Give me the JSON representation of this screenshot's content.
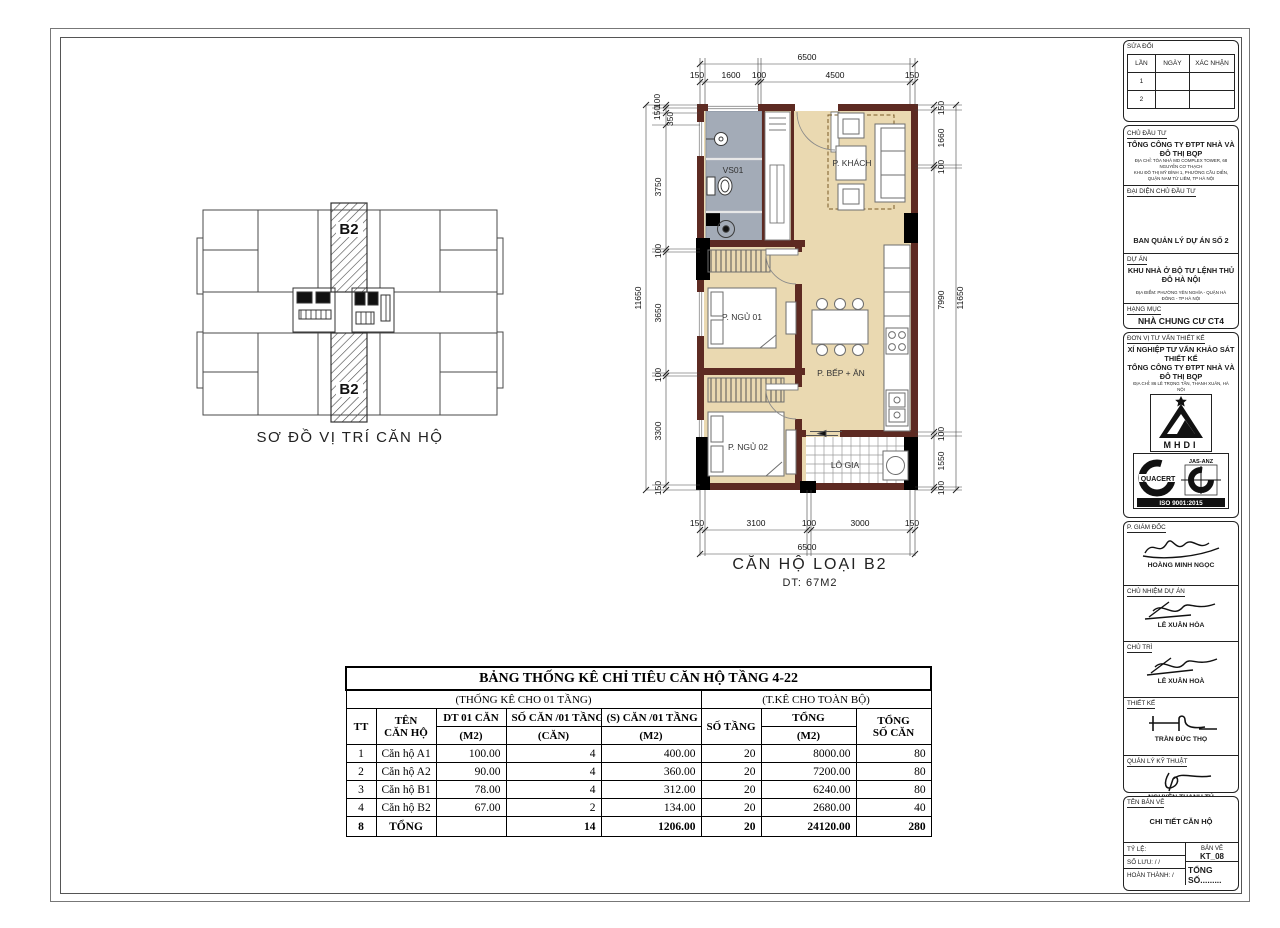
{
  "key_plan": {
    "caption": "SƠ ĐỒ VỊ TRÍ CĂN HỘ",
    "unit_top": "B2",
    "unit_bottom": "B2"
  },
  "floor_plan": {
    "caption_line1": "CĂN HỘ LOẠI B2",
    "caption_line2": "DT: 67M2",
    "rooms": {
      "bath": "VS01",
      "living": "P. KHÁCH",
      "bed1": "P. NGỦ 01",
      "kitchen": "P. BẾP + ĂN",
      "bed2": "P. NGỦ 02",
      "loggia": "LÔ GIA"
    },
    "dims": {
      "top_total": "6500",
      "top_segments": [
        "150",
        "1600",
        "100",
        "4500",
        "150"
      ],
      "bottom_segments": [
        "150",
        "3100",
        "100",
        "3000",
        "150"
      ],
      "bottom_total": "6500",
      "left_total": "11650",
      "left_segments": [
        "100",
        "150",
        "350",
        "3750",
        "100",
        "3650",
        "100",
        "3300",
        "150"
      ],
      "right_segments": [
        "150",
        "1660",
        "100",
        "7990",
        "100",
        "1550",
        "100"
      ],
      "right_total": "11650"
    },
    "colors": {
      "wall": "#5d2a22",
      "floor": "#ead9b1",
      "bath": "#a3abb7"
    }
  },
  "table": {
    "title": "BẢNG THỐNG KÊ CHỈ TIÊU CĂN HỘ TẦNG 4-22",
    "group_left": "(THỐNG KÊ CHO 01 TẦNG)",
    "group_right": "(T.KÊ CHO TOÀN BỘ)",
    "h1": [
      "TT",
      "TÊN",
      "DT 01 CĂN",
      "SỐ CĂN /01 TẦNG",
      "(S) CĂN /01 TẦNG",
      "SỐ TẦNG",
      "TỔNG",
      "TỔNG"
    ],
    "h2": [
      "",
      "CĂN HỘ",
      "(M2)",
      "(CĂN)",
      "(M2)",
      "",
      "(M2)",
      "SỐ CĂN"
    ],
    "rows": [
      [
        "1",
        "Căn hộ A1",
        "100.00",
        "4",
        "400.00",
        "20",
        "8000.00",
        "80"
      ],
      [
        "2",
        "Căn hộ A2",
        "90.00",
        "4",
        "360.00",
        "20",
        "7200.00",
        "80"
      ],
      [
        "3",
        "Căn hộ B1",
        "78.00",
        "4",
        "312.00",
        "20",
        "6240.00",
        "80"
      ],
      [
        "4",
        "Căn hộ B2",
        "67.00",
        "2",
        "134.00",
        "20",
        "2680.00",
        "40"
      ]
    ],
    "total": [
      "8",
      "TỔNG",
      "",
      "14",
      "1206.00",
      "20",
      "24120.00",
      "280"
    ]
  },
  "title_block": {
    "revision": {
      "title": "SỬA ĐỔI",
      "col1": "LẦN",
      "col2": "NGÀY",
      "col3": "XÁC NHẬN",
      "r1": "1",
      "r2": "2"
    },
    "investor": {
      "label": "CHỦ ĐẦU TƯ",
      "name": "TỔNG CÔNG TY ĐTPT NHÀ VÀ ĐÔ THỊ BQP",
      "address1": "ĐỊA CHỈ: TÒA NHÀ MD COMPLEX TOWER, 68 NGUYỄN CƠ THẠCH",
      "address2": "KHU ĐÔ THỊ MỸ ĐÌNH 1, PHƯỜNG CẦU DIỄN, QUẬN NAM TỪ LIÊM, TP HÀ NỘI",
      "rep_label": "ĐẠI DIỆN CHỦ ĐẦU TƯ",
      "rep_name": "BAN QUẢN LÝ DỰ ÁN SỐ 2"
    },
    "project": {
      "label": "DỰ ÁN",
      "name": "KHU NHÀ Ở BỘ TƯ LỆNH THỦ ĐÔ HÀ NỘI",
      "address": "ĐỊA ĐIỂM: PHƯỜNG YÊN NGHĨA - QUẬN HÀ ĐÔNG - TP HÀ NỘI"
    },
    "item": {
      "label": "HẠNG MỤC",
      "name": "NHÀ CHUNG CƯ CT4"
    },
    "consultant": {
      "label": "ĐƠN VỊ TƯ VẤN THIẾT KẾ",
      "line1": "XÍ NGHIỆP TƯ VẤN KHẢO SÁT THIẾT KẾ",
      "line2": "TỔNG CÔNG TY ĐTPT NHÀ VÀ ĐÔ THỊ BQP",
      "address": "ĐỊA CHỈ: 86 LÊ TRỌNG TẤN, THANH XUÂN, HÀ NỘI",
      "logo1_text": "MHDI",
      "logo2_text": "QUACERT",
      "logo2_top": "JAS-ANZ",
      "iso": "ISO 9001:2015"
    },
    "signatures": [
      {
        "role": "P. GIÁM ĐỐC",
        "name": "HOÀNG MINH NGỌC"
      },
      {
        "role": "CHỦ NHIỆM DỰ ÁN",
        "name": "LÊ XUÂN HÒA"
      },
      {
        "role": "CHỦ TRÌ",
        "name": "LÊ XUÂN HOÀ"
      },
      {
        "role": "THIẾT KẾ",
        "name": "TRẦN ĐỨC THỌ"
      },
      {
        "role": "QUẢN LÝ KỸ THUẬT",
        "name": "NGUYỄN THANH TÚ"
      }
    ],
    "drawing": {
      "label": "TÊN BẢN VẼ",
      "name": "CHI TIẾT CĂN HỘ"
    },
    "footer": {
      "scale_label": "TỶ LỆ:",
      "save_label": "SỐ LƯU:      /      /",
      "complete_label": "HOÀN THÀNH:      /",
      "sheet_label": "BẢN VẼ",
      "sheet_no": "KT_08",
      "total_label": "TỔNG SỐ........."
    }
  }
}
